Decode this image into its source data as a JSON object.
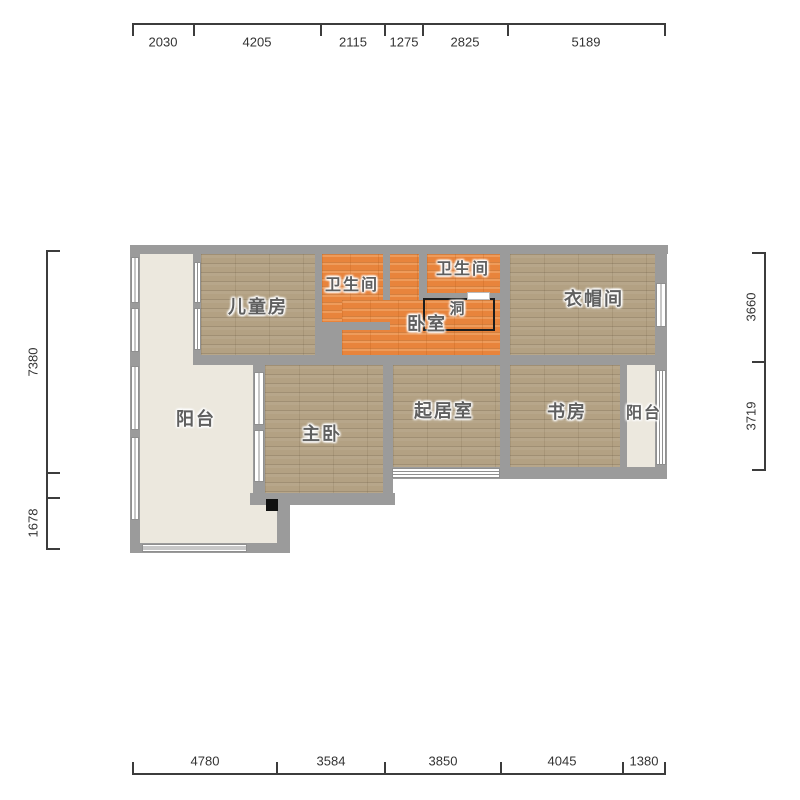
{
  "plan": {
    "colors": {
      "wall": "#9b9b9b",
      "wood": "#b3a183",
      "tile": "#e8843c",
      "plain": "#ece8de",
      "dim": "#3c3c3c",
      "label": "#5f5f5f"
    },
    "floors": [
      {
        "n": "balcony-left-floor",
        "t": "plain",
        "x": 140,
        "y": 254,
        "w": 137,
        "h": 289
      },
      {
        "n": "balcony-right-floor",
        "t": "plain",
        "x": 627,
        "y": 365,
        "w": 28,
        "h": 102
      },
      {
        "n": "children-room-floor",
        "t": "wood",
        "x": 201,
        "y": 254,
        "w": 114,
        "h": 101
      },
      {
        "n": "cloakroom-floor",
        "t": "wood",
        "x": 510,
        "y": 254,
        "w": 145,
        "h": 101
      },
      {
        "n": "master-bedroom-floor",
        "t": "wood",
        "x": 265,
        "y": 365,
        "w": 118,
        "h": 128
      },
      {
        "n": "living-room-floor",
        "t": "wood",
        "x": 393,
        "y": 365,
        "w": 107,
        "h": 102
      },
      {
        "n": "study-floor",
        "t": "wood",
        "x": 510,
        "y": 365,
        "w": 110,
        "h": 102
      },
      {
        "n": "bathroom1-floor",
        "t": "tile",
        "x": 322,
        "y": 254,
        "w": 61,
        "h": 68
      },
      {
        "n": "bathroom2-floor",
        "t": "tile",
        "x": 427,
        "y": 254,
        "w": 73,
        "h": 39
      },
      {
        "n": "bedroom-corridor-floor",
        "t": "tile",
        "x": 389,
        "y": 254,
        "w": 30,
        "h": 76
      },
      {
        "n": "bedroom-floor",
        "t": "tile",
        "x": 342,
        "y": 300,
        "w": 158,
        "h": 55
      }
    ],
    "walls": [
      {
        "n": "wall-top",
        "x": 130,
        "y": 245,
        "w": 538,
        "h": 9
      },
      {
        "n": "wall-left",
        "x": 130,
        "y": 254,
        "w": 10,
        "h": 299
      },
      {
        "n": "wall-right",
        "x": 655,
        "y": 254,
        "w": 12,
        "h": 225
      },
      {
        "n": "wall-bottom-main",
        "x": 383,
        "y": 467,
        "w": 284,
        "h": 12
      },
      {
        "n": "wall-balcony-bottom",
        "x": 130,
        "y": 543,
        "w": 160,
        "h": 10
      },
      {
        "n": "wall-balcony-step",
        "x": 277,
        "y": 498,
        "w": 13,
        "h": 45
      },
      {
        "n": "wall-master-bottom",
        "x": 250,
        "y": 493,
        "w": 145,
        "h": 12
      },
      {
        "n": "wall-children-left",
        "x": 193,
        "y": 254,
        "w": 8,
        "h": 101
      },
      {
        "n": "wall-row-divider",
        "x": 193,
        "y": 355,
        "w": 474,
        "h": 10
      },
      {
        "n": "wall-master-living",
        "x": 383,
        "y": 365,
        "w": 10,
        "h": 128
      },
      {
        "n": "wall-center-vertical",
        "x": 500,
        "y": 254,
        "w": 10,
        "h": 213
      },
      {
        "n": "wall-study-balcony",
        "x": 620,
        "y": 365,
        "w": 7,
        "h": 102
      },
      {
        "n": "wall-master-left",
        "x": 253,
        "y": 365,
        "w": 12,
        "h": 128
      },
      {
        "n": "wall-bath1-left",
        "x": 315,
        "y": 254,
        "w": 7,
        "h": 76
      },
      {
        "n": "wall-bath1-right",
        "x": 383,
        "y": 254,
        "w": 7,
        "h": 46
      },
      {
        "n": "wall-bath1-bottom",
        "x": 315,
        "y": 322,
        "w": 75,
        "h": 8
      },
      {
        "n": "wall-pier",
        "x": 315,
        "y": 322,
        "w": 27,
        "h": 43
      },
      {
        "n": "wall-bath2-left",
        "x": 419,
        "y": 254,
        "w": 8,
        "h": 39
      },
      {
        "n": "wall-bath2-bottom",
        "x": 419,
        "y": 293,
        "w": 91,
        "h": 7
      }
    ],
    "windows": [
      {
        "n": "window-balcony-left-1",
        "x": 131,
        "y": 257,
        "w": 8,
        "h": 46,
        "s": "v1"
      },
      {
        "n": "window-balcony-left-2",
        "x": 131,
        "y": 308,
        "w": 8,
        "h": 44,
        "s": "v1"
      },
      {
        "n": "window-balcony-left-3",
        "x": 131,
        "y": 366,
        "w": 8,
        "h": 64,
        "s": "v1"
      },
      {
        "n": "window-balcony-left-4",
        "x": 131,
        "y": 437,
        "w": 8,
        "h": 83,
        "s": "v1"
      },
      {
        "n": "window-children-1",
        "x": 194,
        "y": 262,
        "w": 7,
        "h": 41,
        "s": "v1"
      },
      {
        "n": "window-children-2",
        "x": 194,
        "y": 308,
        "w": 7,
        "h": 42,
        "s": "v1"
      },
      {
        "n": "window-master-1",
        "x": 254,
        "y": 372,
        "w": 10,
        "h": 53,
        "s": "v1"
      },
      {
        "n": "window-master-2",
        "x": 254,
        "y": 430,
        "w": 10,
        "h": 52,
        "s": "v1"
      },
      {
        "n": "window-balcony-bottom",
        "x": 142,
        "y": 544,
        "w": 105,
        "h": 8,
        "s": "h2"
      },
      {
        "n": "window-living-bottom",
        "x": 392,
        "y": 468,
        "w": 108,
        "h": 10,
        "s": "h2"
      },
      {
        "n": "window-cloakroom-right",
        "x": 656,
        "y": 283,
        "w": 10,
        "h": 44,
        "s": "v1"
      },
      {
        "n": "window-balcony-right",
        "x": 656,
        "y": 370,
        "w": 10,
        "h": 95,
        "s": "v2"
      }
    ],
    "marks": [
      {
        "n": "door-pivot-square",
        "t": "square",
        "x": 266,
        "y": 499,
        "w": 12,
        "h": 12
      },
      {
        "n": "wall-hole-outline",
        "t": "hole",
        "x": 423,
        "y": 298,
        "w": 72,
        "h": 33
      },
      {
        "n": "opening-lintel",
        "t": "lintel",
        "x": 467,
        "y": 292,
        "w": 23,
        "h": 8
      }
    ],
    "labels": [
      {
        "n": "room-label-children",
        "text": "儿童房",
        "x": 258,
        "y": 306,
        "size": 18
      },
      {
        "n": "room-label-bathroom-1",
        "text": "卫生间",
        "x": 352,
        "y": 283,
        "size": 16
      },
      {
        "n": "room-label-bathroom-2",
        "text": "卫生间",
        "x": 463,
        "y": 267,
        "size": 16
      },
      {
        "n": "room-label-bedroom",
        "text": "卧室",
        "x": 427,
        "y": 323,
        "size": 18
      },
      {
        "n": "room-label-hole",
        "text": "洞",
        "x": 458,
        "y": 308,
        "size": 15
      },
      {
        "n": "room-label-cloakroom",
        "text": "衣帽间",
        "x": 594,
        "y": 298,
        "size": 18
      },
      {
        "n": "room-label-balcony-left",
        "text": "阳台",
        "x": 196,
        "y": 418,
        "size": 18
      },
      {
        "n": "room-label-master",
        "text": "主卧",
        "x": 322,
        "y": 433,
        "size": 18
      },
      {
        "n": "room-label-living",
        "text": "起居室",
        "x": 444,
        "y": 410,
        "size": 18
      },
      {
        "n": "room-label-study",
        "text": "书房",
        "x": 567,
        "y": 411,
        "size": 18
      },
      {
        "n": "room-label-balcony-right",
        "text": "阳台",
        "x": 644,
        "y": 411,
        "size": 16
      }
    ]
  },
  "dims": {
    "top": {
      "line": {
        "x1": 133,
        "x2": 665,
        "y": 23
      },
      "tickDir": "down",
      "ticks": [
        133,
        194,
        321,
        385,
        423,
        508,
        665
      ],
      "labelY": 42,
      "labels": [
        {
          "text": "2030",
          "x": 163
        },
        {
          "text": "4205",
          "x": 257
        },
        {
          "text": "2115",
          "x": 353
        },
        {
          "text": "1275",
          "x": 404
        },
        {
          "text": "2825",
          "x": 465
        },
        {
          "text": "5189",
          "x": 586
        }
      ]
    },
    "bottom": {
      "line": {
        "x1": 133,
        "x2": 665,
        "y": 773
      },
      "tickDir": "up",
      "ticks": [
        133,
        277,
        385,
        501,
        623,
        665
      ],
      "labelY": 761,
      "labels": [
        {
          "text": "4780",
          "x": 205
        },
        {
          "text": "3584",
          "x": 331
        },
        {
          "text": "3850",
          "x": 443
        },
        {
          "text": "4045",
          "x": 562
        },
        {
          "text": "1380",
          "x": 644
        }
      ]
    },
    "left": {
      "line": {
        "y1": 251,
        "y2": 549,
        "x": 46
      },
      "tickDir": "right",
      "ticks": [
        251,
        473,
        498,
        549
      ],
      "labelX": 33,
      "labels": [
        {
          "text": "7380",
          "y": 362
        },
        {
          "text": "1678",
          "y": 523
        }
      ]
    },
    "right": {
      "line": {
        "y1": 253,
        "y2": 470,
        "x": 764
      },
      "tickDir": "left",
      "ticks": [
        253,
        362,
        470
      ],
      "labelX": 751,
      "labels": [
        {
          "text": "3660",
          "y": 307
        },
        {
          "text": "3719",
          "y": 416
        }
      ]
    }
  }
}
